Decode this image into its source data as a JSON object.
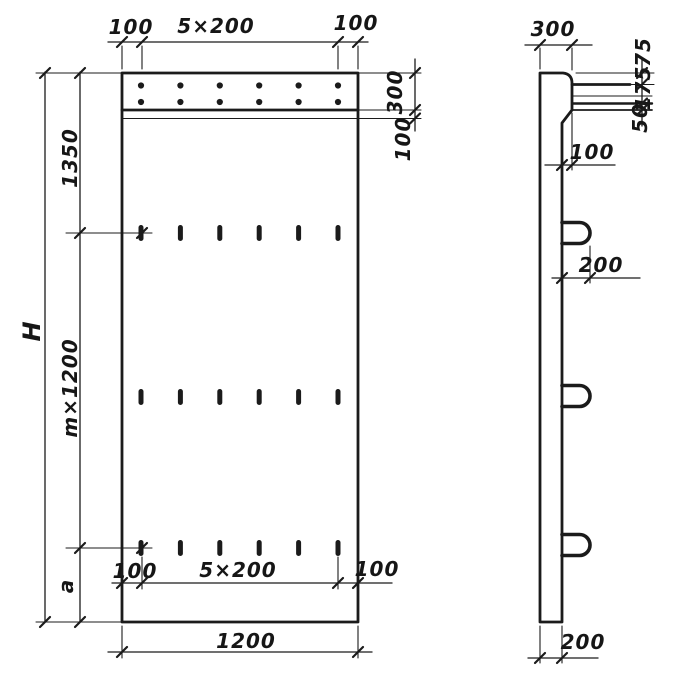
{
  "meta": {
    "type": "technical-drawing",
    "subject": "Precast concrete wall panel — front elevation and side section with dimensions"
  },
  "colors": {
    "ink": "#1b1b1b",
    "paper": "#ffffff"
  },
  "front_view": {
    "top_dims": {
      "left": "100",
      "center": "5×200",
      "right": "100"
    },
    "left_dims": {
      "overall": "H",
      "upper": "1350",
      "middle": "m×1200",
      "lower": "a"
    },
    "right_dims": {
      "upper": "300",
      "lower": "100"
    },
    "bottom_inner_dims": {
      "left": "100",
      "center": "5×200",
      "right": "100"
    },
    "bottom_overall_dim": "1200",
    "holes": {
      "rows": 2,
      "columns": 6
    },
    "slots": {
      "rows": 3,
      "columns": 6
    }
  },
  "side_view": {
    "top_dim": "300",
    "right_dims": {
      "upper": "75",
      "middle": "175",
      "lower": "50"
    },
    "step_dim": "100",
    "loop_dim": "200",
    "bottom_dim": "200",
    "loops": {
      "count": 3
    }
  }
}
